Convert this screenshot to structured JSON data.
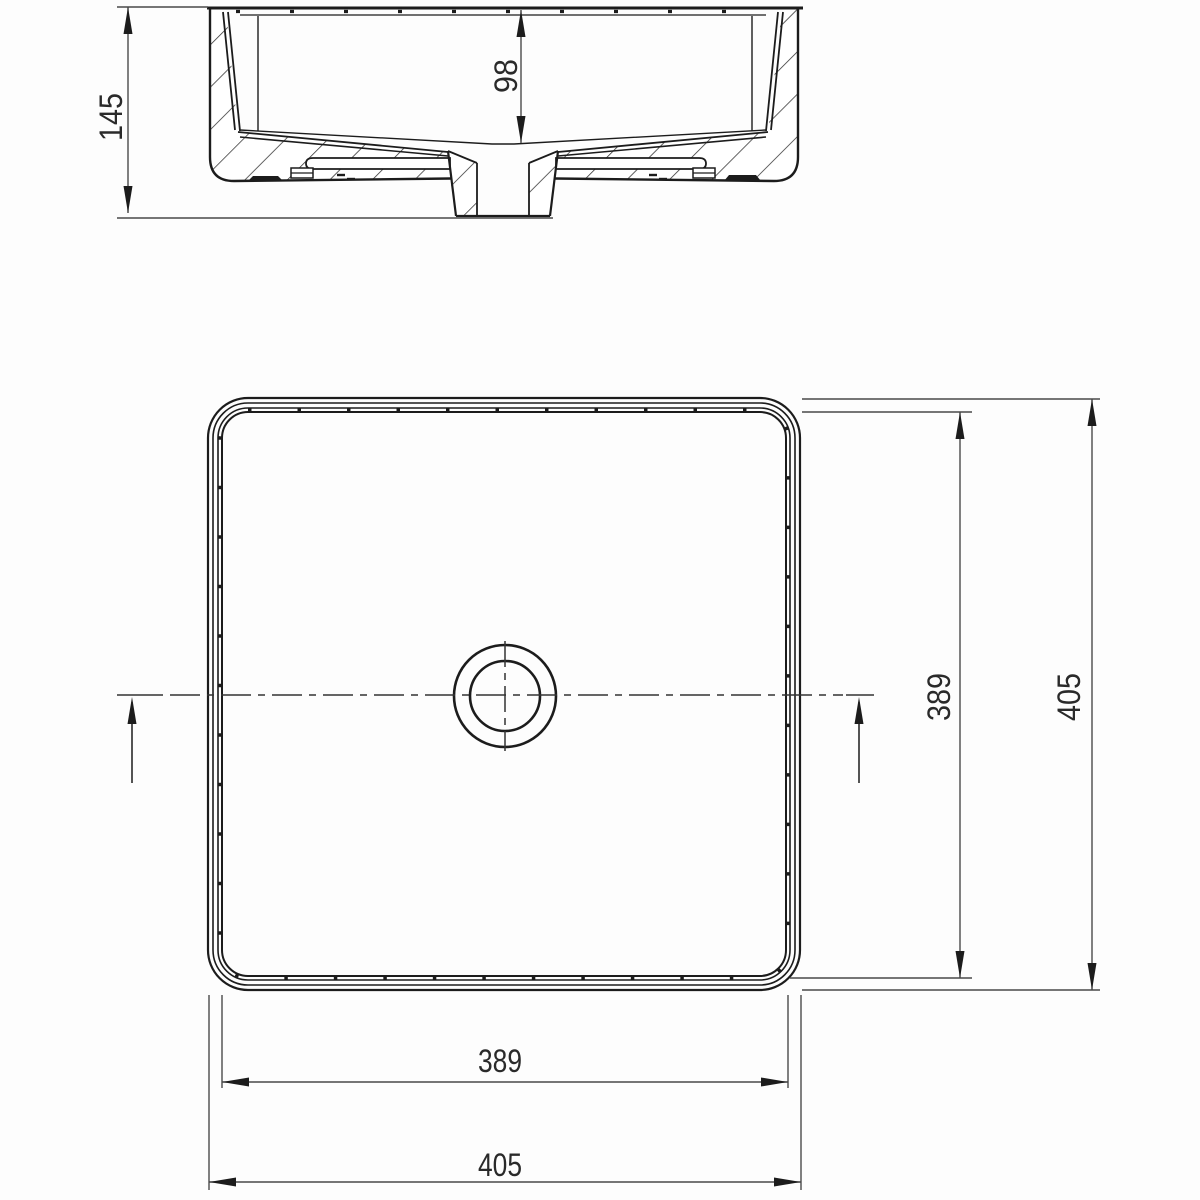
{
  "drawing": {
    "subject": "square-countertop-washbasin-technical-drawing",
    "background": "#fdfdfd",
    "line_color": "#1c1c1c",
    "dimension_color": "#4a4a4a",
    "section_view": {
      "overall_height": "145",
      "bowl_depth": "98"
    },
    "top_view": {
      "inner_width": "389",
      "outer_width": "405",
      "inner_length": "389",
      "outer_length": "405"
    }
  }
}
